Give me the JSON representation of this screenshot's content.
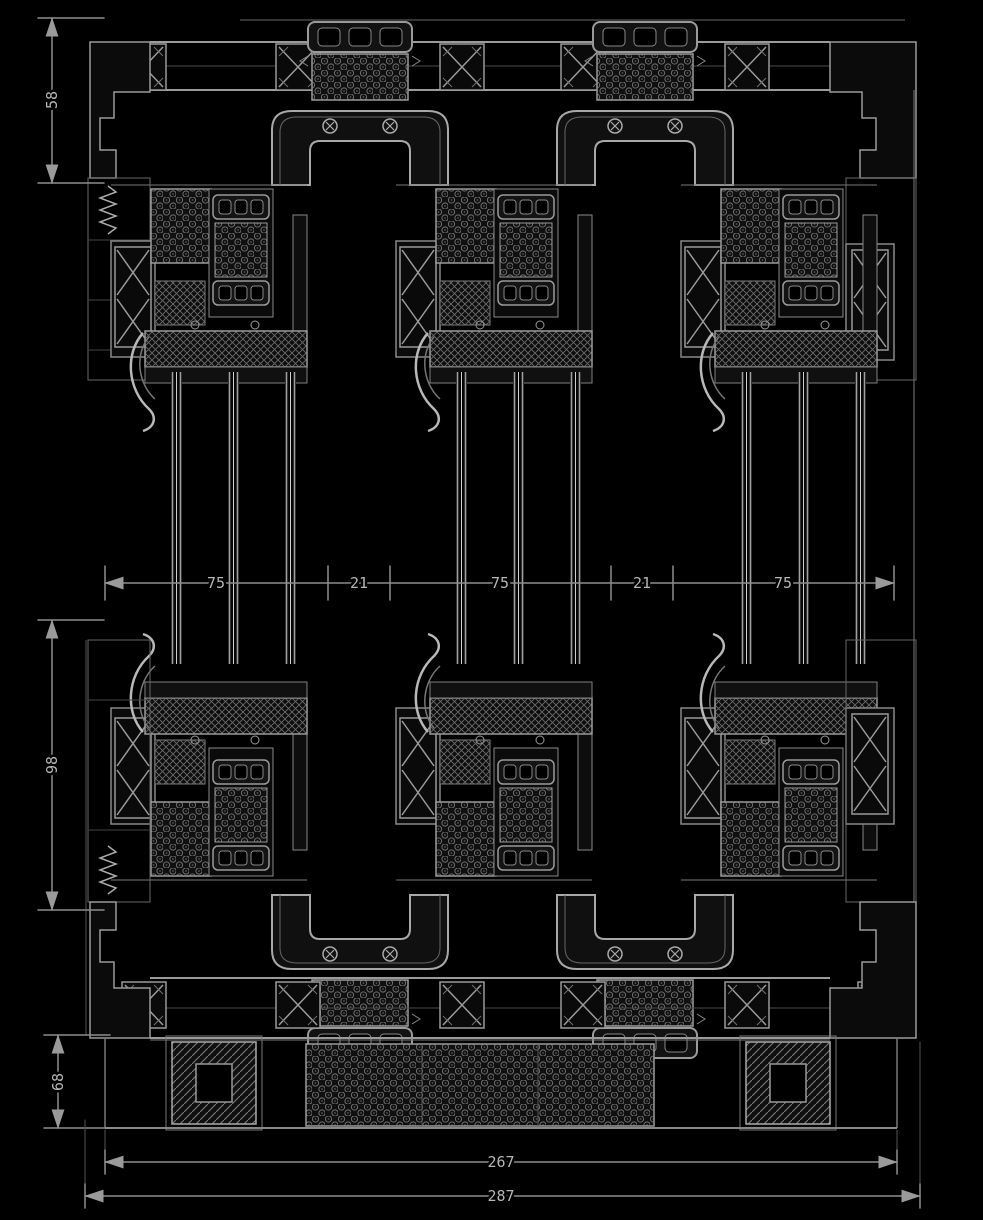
{
  "drawing": {
    "colors": {
      "background": "#000000",
      "line": "#9a9a9a",
      "line_bright": "#c8c8c8",
      "line_dim": "#5f5f5f",
      "pattern": "#6f6f6f",
      "dim_line": "#8d8d8d",
      "dim_text": "#b6b6b6"
    },
    "dims": {
      "v_top": "58",
      "v_mid": "98",
      "v_bot": "68",
      "row": [
        "75",
        "21",
        "75",
        "21",
        "75"
      ],
      "w_inner": "267",
      "w_outer": "287"
    }
  }
}
